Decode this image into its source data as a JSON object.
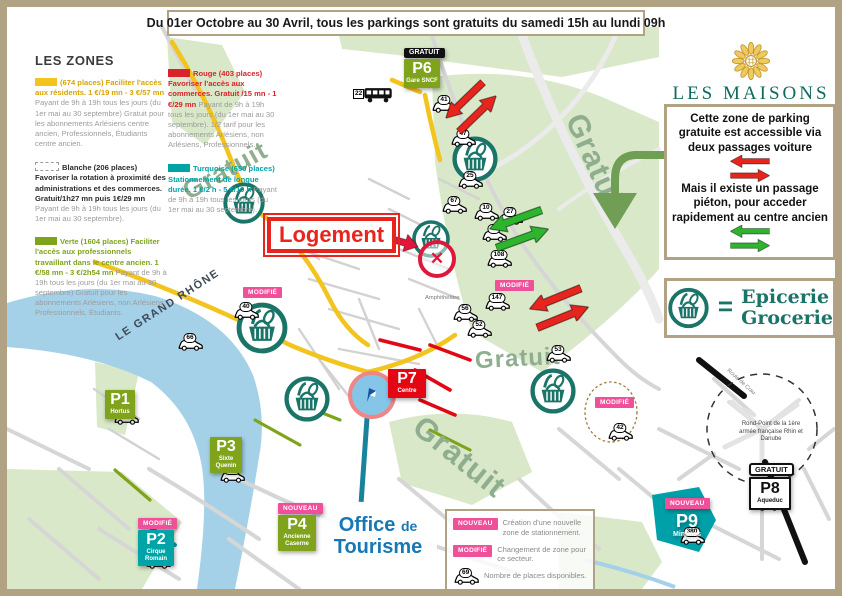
{
  "colors": {
    "tan": "#b2a284",
    "yellow": "#f2c41d",
    "gold": "#d9a400",
    "green": "#7fa31b",
    "red": "#d8232a",
    "teal": "#00a3a6",
    "dteal": "#1b7468",
    "pink": "#f0509a",
    "blue": "#1778b5",
    "pred": "#e30613",
    "logoteal": "#0e6a5e",
    "logogold": "#c79a2e",
    "grat": "#8fae8f",
    "arred": "#e8241e",
    "argreen": "#2db52d"
  },
  "banner": {
    "text": "Du 01er Octobre au 30 Avril, tous les parkings sont gratuits du samedi 15h au lundi 09h"
  },
  "logo": {
    "title": "LES MAISONS",
    "subtitle": "de Vincent"
  },
  "zones_legend": {
    "title": "LES ZONES",
    "items": [
      {
        "headline": "(674 places) Faciliter l'accès aux résidents. 1 €/19 mn  -  3 €/57 mn",
        "body": "Payant de 9h à 19h tous les jours (du 1er mai au 30 septembre) Gratuit pour les abonnements Arlésiens centre ancien, Professionnels, Étudiants centre ancien."
      },
      {
        "headline": "Blanche (206 places) Favoriser la rotation à proximité des administrations et des commerces. Gratuit/1h27 mn puis 1€/29 mn",
        "body": "Payant de 9h à 19h tous les jours (du 1er mai au 30 septembre)."
      },
      {
        "headline": "Verte (1604 places) Faciliter l'accès aux professionnels travaillant dans le centre ancien. 1 €/58 mn  -  3 €/2h54 mn",
        "body": "Payant de 9h à 19h tous les jours (du 1er mai au 30 septembre) Gratuit pour les abonnements Arlésiens, non Arlésiens, Professionnels, Étudiants."
      }
    ]
  },
  "pricing_legend": {
    "items": [
      {
        "headline": "Rouge (403 places) Favoriser l'accès aux commerces. Gratuit /15 mn  -  1 €/29 mn",
        "body": "Payant de 9h à 19h tous les jours (du 1er mai au 30 septembre). 1/2 tarif pour les abonnements Arlésiens, non Arlésiens, Professionnels."
      },
      {
        "headline": "Turquoise (650 places) Stationnement de longue durée. 1 €/2 h  -  5 €/10 h",
        "body": "Payant de 9h à 19h tous les jours (du 1er mai au 30 septembre)."
      }
    ]
  },
  "info_box": {
    "para1": "Cette zone de parking gratuite est accessible via deux passages voiture",
    "para2": "Mais il existe un passage piéton, pour acceder rapidement au centre ancien"
  },
  "epicerie_box": {
    "equals": "=",
    "line1": "Epicerie",
    "line2": "Grocerie"
  },
  "map": {
    "gratuit_labels": [
      "Gratuit",
      "Gratuit",
      "Gratuit",
      "Gratuit"
    ],
    "river_label": "LE GRAND RHÔNE",
    "logement_label": "Logement",
    "office_line1": "Office",
    "office_de": "de",
    "office_line2": "Tourisme",
    "amphi_label": "Amphithéâtre",
    "roundabout_text": "Rond-Point de la 1ère armée française Rhin et Danube",
    "route_label": "Route de Crau",
    "bus_number": "22",
    "parkings": [
      {
        "id": "P1",
        "sub": "Hortus"
      },
      {
        "id": "P2",
        "sub": "Cirque Romain",
        "tag": "MODIFIÉ"
      },
      {
        "id": "P3",
        "sub": "Sixte Quenin"
      },
      {
        "id": "P4",
        "sub": "Ancienne Caserne",
        "tag": "NOUVEAU"
      },
      {
        "id": "P6",
        "sub": "Gare SNCF",
        "tag": "GRATUIT"
      },
      {
        "id": "P7",
        "sub": "Centre"
      },
      {
        "id": "P8",
        "sub": "Aqueduc",
        "tag": "GRATUIT"
      },
      {
        "id": "P9",
        "sub": "Minimes",
        "tag": "NOUVEAU"
      }
    ],
    "modified_tag": "MODIFIÉ",
    "cars": [
      {
        "n": "41"
      },
      {
        "n": "47"
      },
      {
        "n": "25"
      },
      {
        "n": "67"
      },
      {
        "n": "10"
      },
      {
        "n": "27"
      },
      {
        "n": "43"
      },
      {
        "n": "108"
      },
      {
        "n": "147"
      },
      {
        "n": "66"
      },
      {
        "n": "40"
      },
      {
        "n": "56"
      },
      {
        "n": "52"
      },
      {
        "n": "53"
      },
      {
        "n": "42"
      },
      {
        "n": "65"
      },
      {
        "n": "134"
      },
      {
        "n": "255"
      },
      {
        "n": "100"
      },
      {
        "n": "380"
      },
      {
        "n": "23"
      }
    ]
  },
  "bottom_legend": {
    "items": [
      {
        "tag": "NOUVEAU",
        "text": "Création d'une nouvelle zone de stationnement."
      },
      {
        "tag": "MODIFIÉ",
        "text": "Changement de zone pour ce secteur."
      },
      {
        "car": "69",
        "text": "Nombre de places disponibles."
      }
    ]
  }
}
